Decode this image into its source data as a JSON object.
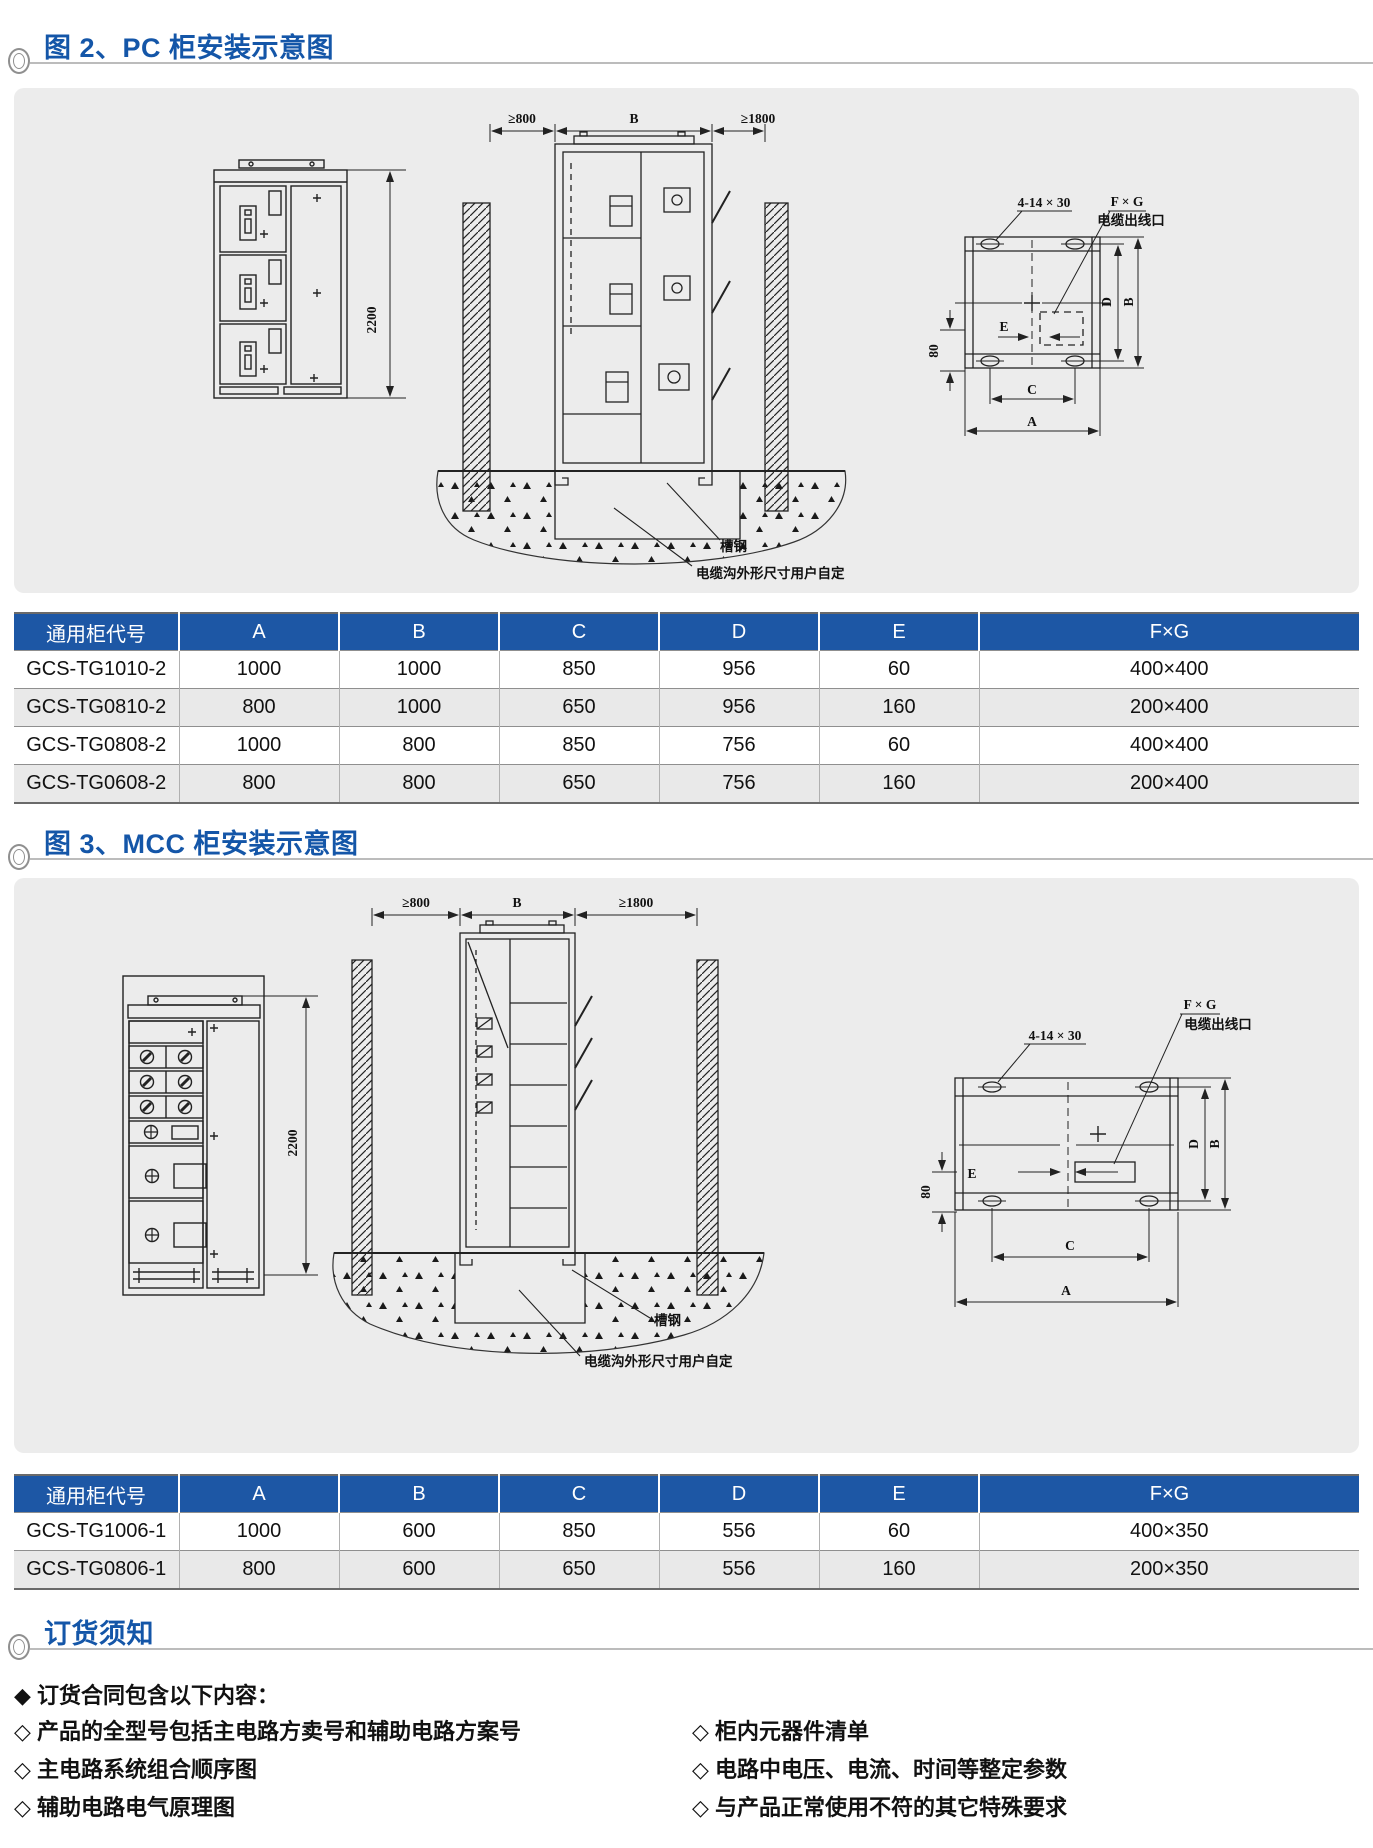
{
  "colors": {
    "accent_blue": "#1456a8",
    "table_header_bg": "#1d57a5",
    "panel_bg": "#ececec",
    "row_alt_bg": "#e9e9e9",
    "rule_gray": "#bcbcbc"
  },
  "fig2": {
    "title": "图 2、PC 柜安装示意图",
    "labels": {
      "height": "2200",
      "clearance_left": "≥800",
      "top_b": "B",
      "clearance_right": "≥1800",
      "holes": "4-14 × 30",
      "fxg": "F × G",
      "cable_outlet": "电缆出线口",
      "dim_e": "E",
      "dim_80": "80",
      "dim_c": "C",
      "dim_a": "A",
      "dim_d": "D",
      "dim_b": "B",
      "channel_steel": "槽钢",
      "trench_note": "电缆沟外形尺寸用户自定"
    },
    "table": {
      "headers": [
        "通用柜代号",
        "A",
        "B",
        "C",
        "D",
        "E",
        "F×G"
      ],
      "rows": [
        [
          "GCS-TG1010-2",
          "1000",
          "1000",
          "850",
          "956",
          "60",
          "400×400"
        ],
        [
          "GCS-TG0810-2",
          "800",
          "1000",
          "650",
          "956",
          "160",
          "200×400"
        ],
        [
          "GCS-TG0808-2",
          "1000",
          "800",
          "850",
          "756",
          "60",
          "400×400"
        ],
        [
          "GCS-TG0608-2",
          "800",
          "800",
          "650",
          "756",
          "160",
          "200×400"
        ]
      ]
    }
  },
  "fig3": {
    "title": "图 3、MCC 柜安装示意图",
    "labels": {
      "height": "2200",
      "clearance_left": "≥800",
      "top_b": "B",
      "clearance_right": "≥1800",
      "holes": "4-14 × 30",
      "fxg": "F × G",
      "cable_outlet": "电缆出线口",
      "dim_e": "E",
      "dim_80": "80",
      "dim_c": "C",
      "dim_a": "A",
      "dim_d": "D",
      "dim_b": "B",
      "channel_steel": "槽钢",
      "trench_note": "电缆沟外形尺寸用户自定"
    },
    "table": {
      "headers": [
        "通用柜代号",
        "A",
        "B",
        "C",
        "D",
        "E",
        "F×G"
      ],
      "rows": [
        [
          "GCS-TG1006-1",
          "1000",
          "600",
          "850",
          "556",
          "60",
          "400×350"
        ],
        [
          "GCS-TG0806-1",
          "800",
          "600",
          "650",
          "556",
          "160",
          "200×350"
        ]
      ]
    }
  },
  "ordering": {
    "title": "订货须知",
    "heading": "◆ 订货合同包含以下内容：",
    "left_items": [
      "◇ 产品的全型号包括主电路方卖号和辅助电路方案号",
      "◇ 主电路系统组合顺序图",
      "◇ 辅助电路电气原理图"
    ],
    "right_items": [
      "◇ 柜内元器件清单",
      "◇ 电路中电压、电流、时间等整定参数",
      "◇ 与产品正常使用不符的其它特殊要求"
    ]
  }
}
